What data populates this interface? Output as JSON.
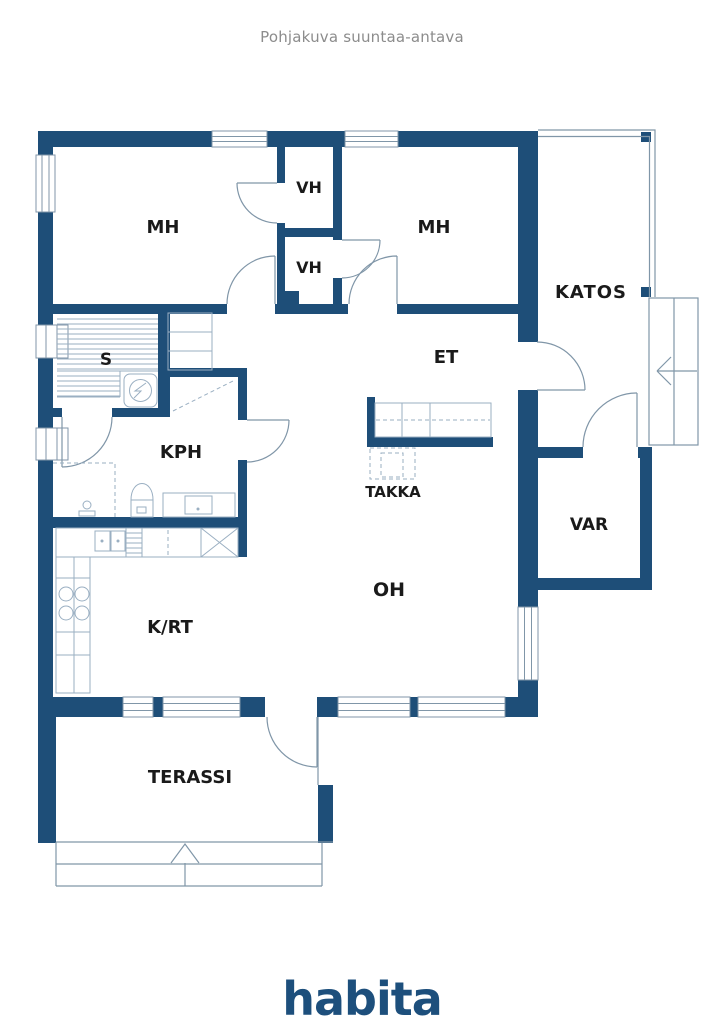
{
  "title": "Pohjakuva suuntaa-antava",
  "brand": {
    "logo_text": "habita"
  },
  "rooms": {
    "bedroom_left": "MH",
    "closet_top": "VH",
    "closet_bottom": "VH",
    "bedroom_right": "MH",
    "porch": "KATOS",
    "sauna": "S",
    "entry": "ET",
    "fireplace": "TAKKA",
    "bathroom": "KPH",
    "storage": "VAR",
    "living_room": "OH",
    "kitchen_dining": "K/RT",
    "terrace": "TERASSI"
  },
  "colors": {
    "wall": "#1E4E78",
    "fixture_line": "#9AAFC2",
    "outline_line": "#8096A8",
    "label_text": "#1A1A1A",
    "title_text": "#8C8C8C",
    "logo_blue": "#1D4F7C",
    "background": "#FFFFFF"
  }
}
